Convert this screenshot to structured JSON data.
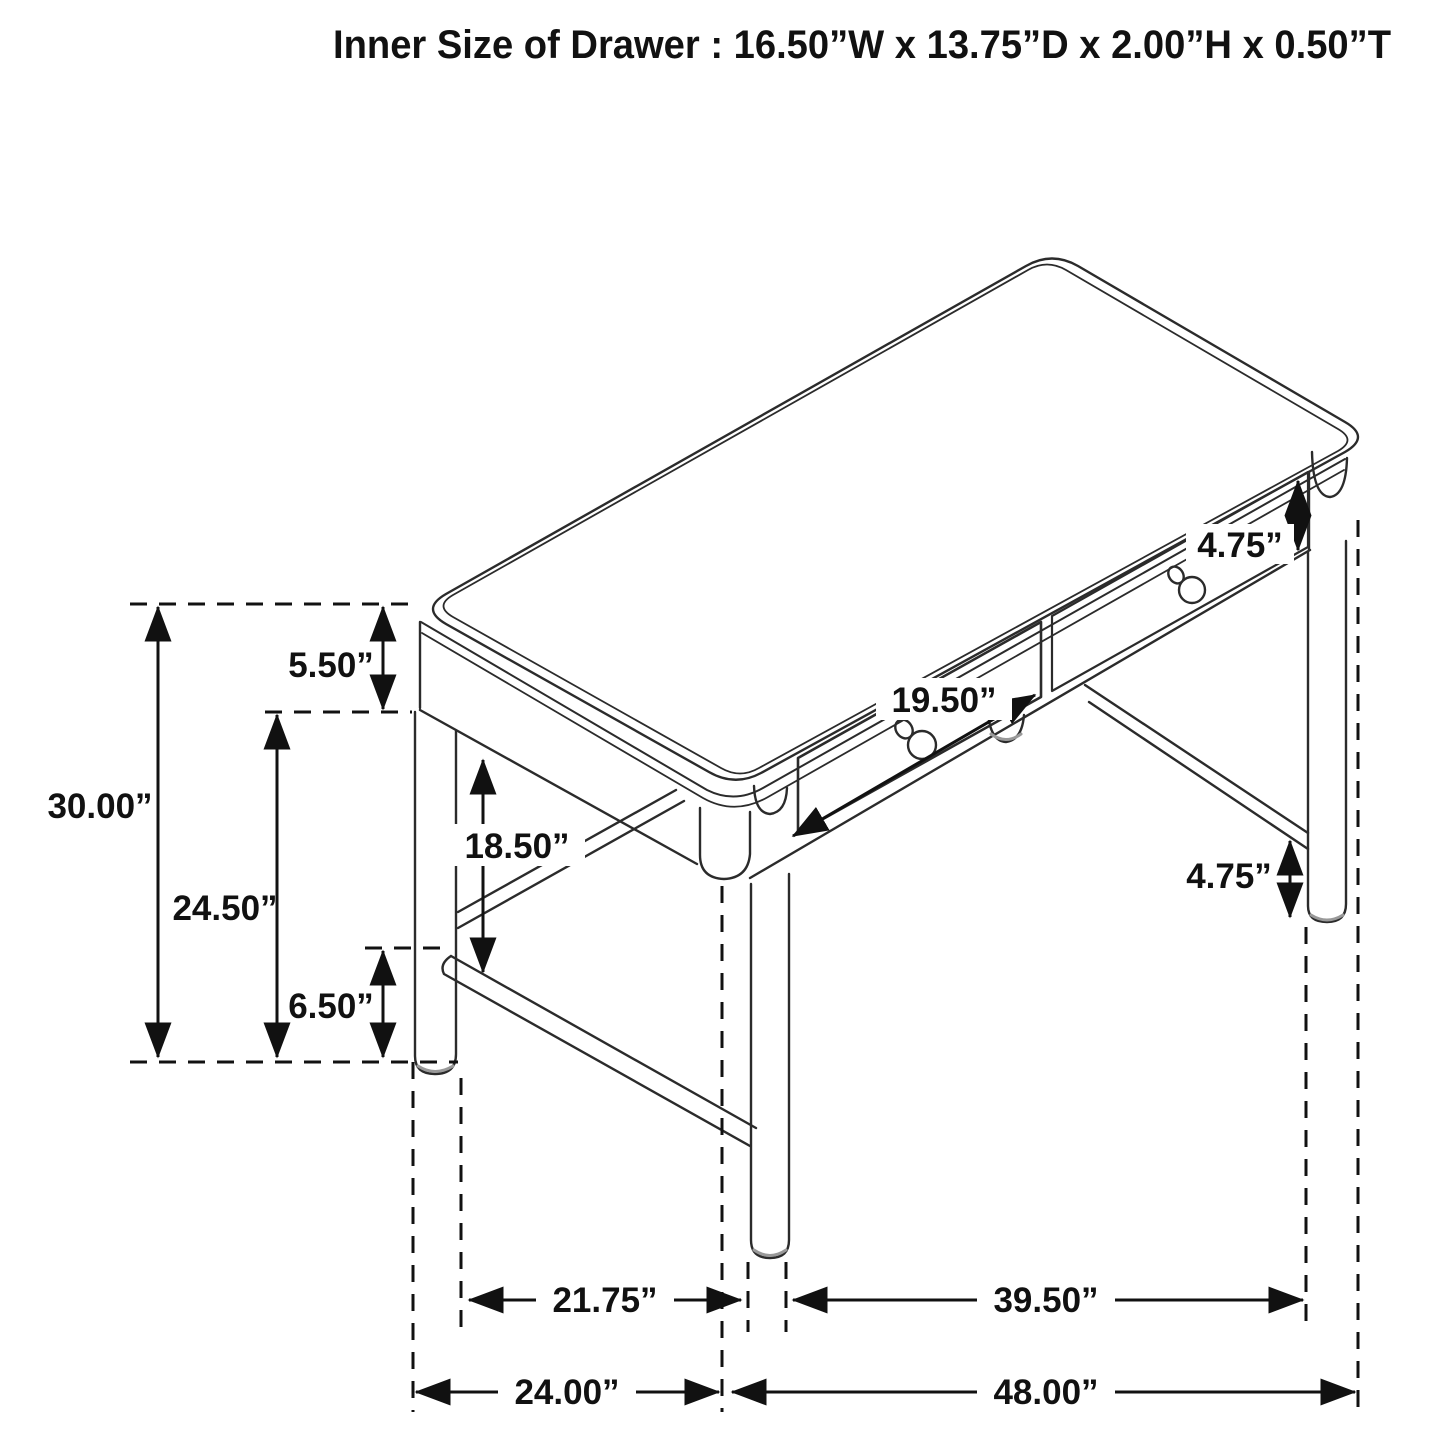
{
  "title": "Inner Size of Drawer : 16.50”W x 13.75”D x 2.00”H x 0.50”T",
  "figure": {
    "kind": "isometric technical line drawing",
    "subject": "writing desk with two front drawers, round legs and stretchers"
  },
  "colors": {
    "line": "#2b2b2b",
    "dimension": "#111111",
    "background": "#ffffff",
    "shade": "#999999"
  },
  "dims": {
    "overall_height": "30.00”",
    "apron_drop": "5.50”",
    "clearance_height": "24.50”",
    "stretcher_height": "6.50”",
    "knee_clearance": "18.50”",
    "drawer_width": "19.50”",
    "right_apron_height": "4.75”",
    "leg_bottom_height": "4.75”",
    "side_leg_span": "21.75”",
    "front_leg_span": "39.50”",
    "overall_depth": "24.00”",
    "overall_width": "48.00”"
  }
}
